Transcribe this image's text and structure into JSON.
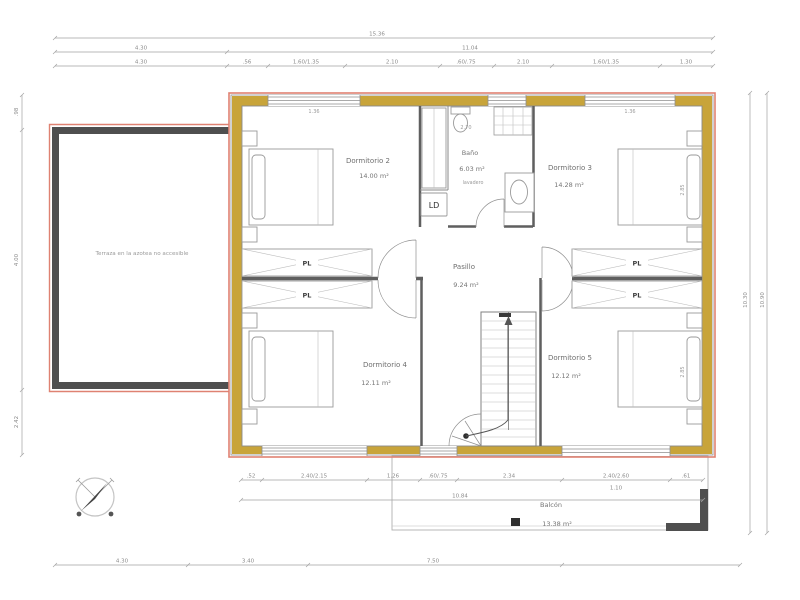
{
  "plan": {
    "rooms": {
      "d2": {
        "name": "Dormitorio 2",
        "area": "14.00 m²"
      },
      "d3": {
        "name": "Dormitorio 3",
        "area": "14.28 m²"
      },
      "d4": {
        "name": "Dormitorio 4",
        "area": "12.11 m²"
      },
      "d5": {
        "name": "Dormitorio 5",
        "area": "12.12 m²"
      },
      "bath": {
        "name": "Baño",
        "area": "6.03 m²",
        "note": "lavadero"
      },
      "hall": {
        "name": "Pasillo",
        "area": "9.24 m²"
      },
      "balcony": {
        "name": "Balcón",
        "area": "13.38 m²"
      },
      "terrace": {
        "name": "Terraza en la azotea no accesible"
      }
    },
    "fixtures": {
      "washer": "LD",
      "closet": "PL"
    },
    "dims": {
      "overall_width": "15.36",
      "row2": [
        "4.30",
        "11.04"
      ],
      "row3": [
        "4.30",
        ".56",
        "1.60/1.35",
        "2.10",
        ".60/.75",
        "2.10",
        "1.60/1.35",
        "1.30"
      ],
      "bottom_inner": [
        ".52",
        "2.40/2.15",
        "1.26",
        ".60/.75",
        "2.34",
        "2.40/2.60",
        ".61"
      ],
      "bottom_inner_extra": "1.10",
      "bottom_width": "10.84",
      "bottom_outer": [
        "4.30",
        "3.40",
        "7.50"
      ],
      "left": [
        ".98",
        "4.00",
        "2.42"
      ],
      "right": [
        "10.30",
        "10.90"
      ],
      "window_d2": "1.36",
      "window_d3": "1.36",
      "bath_width": "2.70",
      "depth_d3": "2.85",
      "depth_d5": "2.85"
    },
    "colors": {
      "wall_fill": "#c8a43a",
      "outer_line": "#df8272",
      "terrace_border": "#4f4f4f",
      "dim_line": "#a3a3a3"
    }
  }
}
